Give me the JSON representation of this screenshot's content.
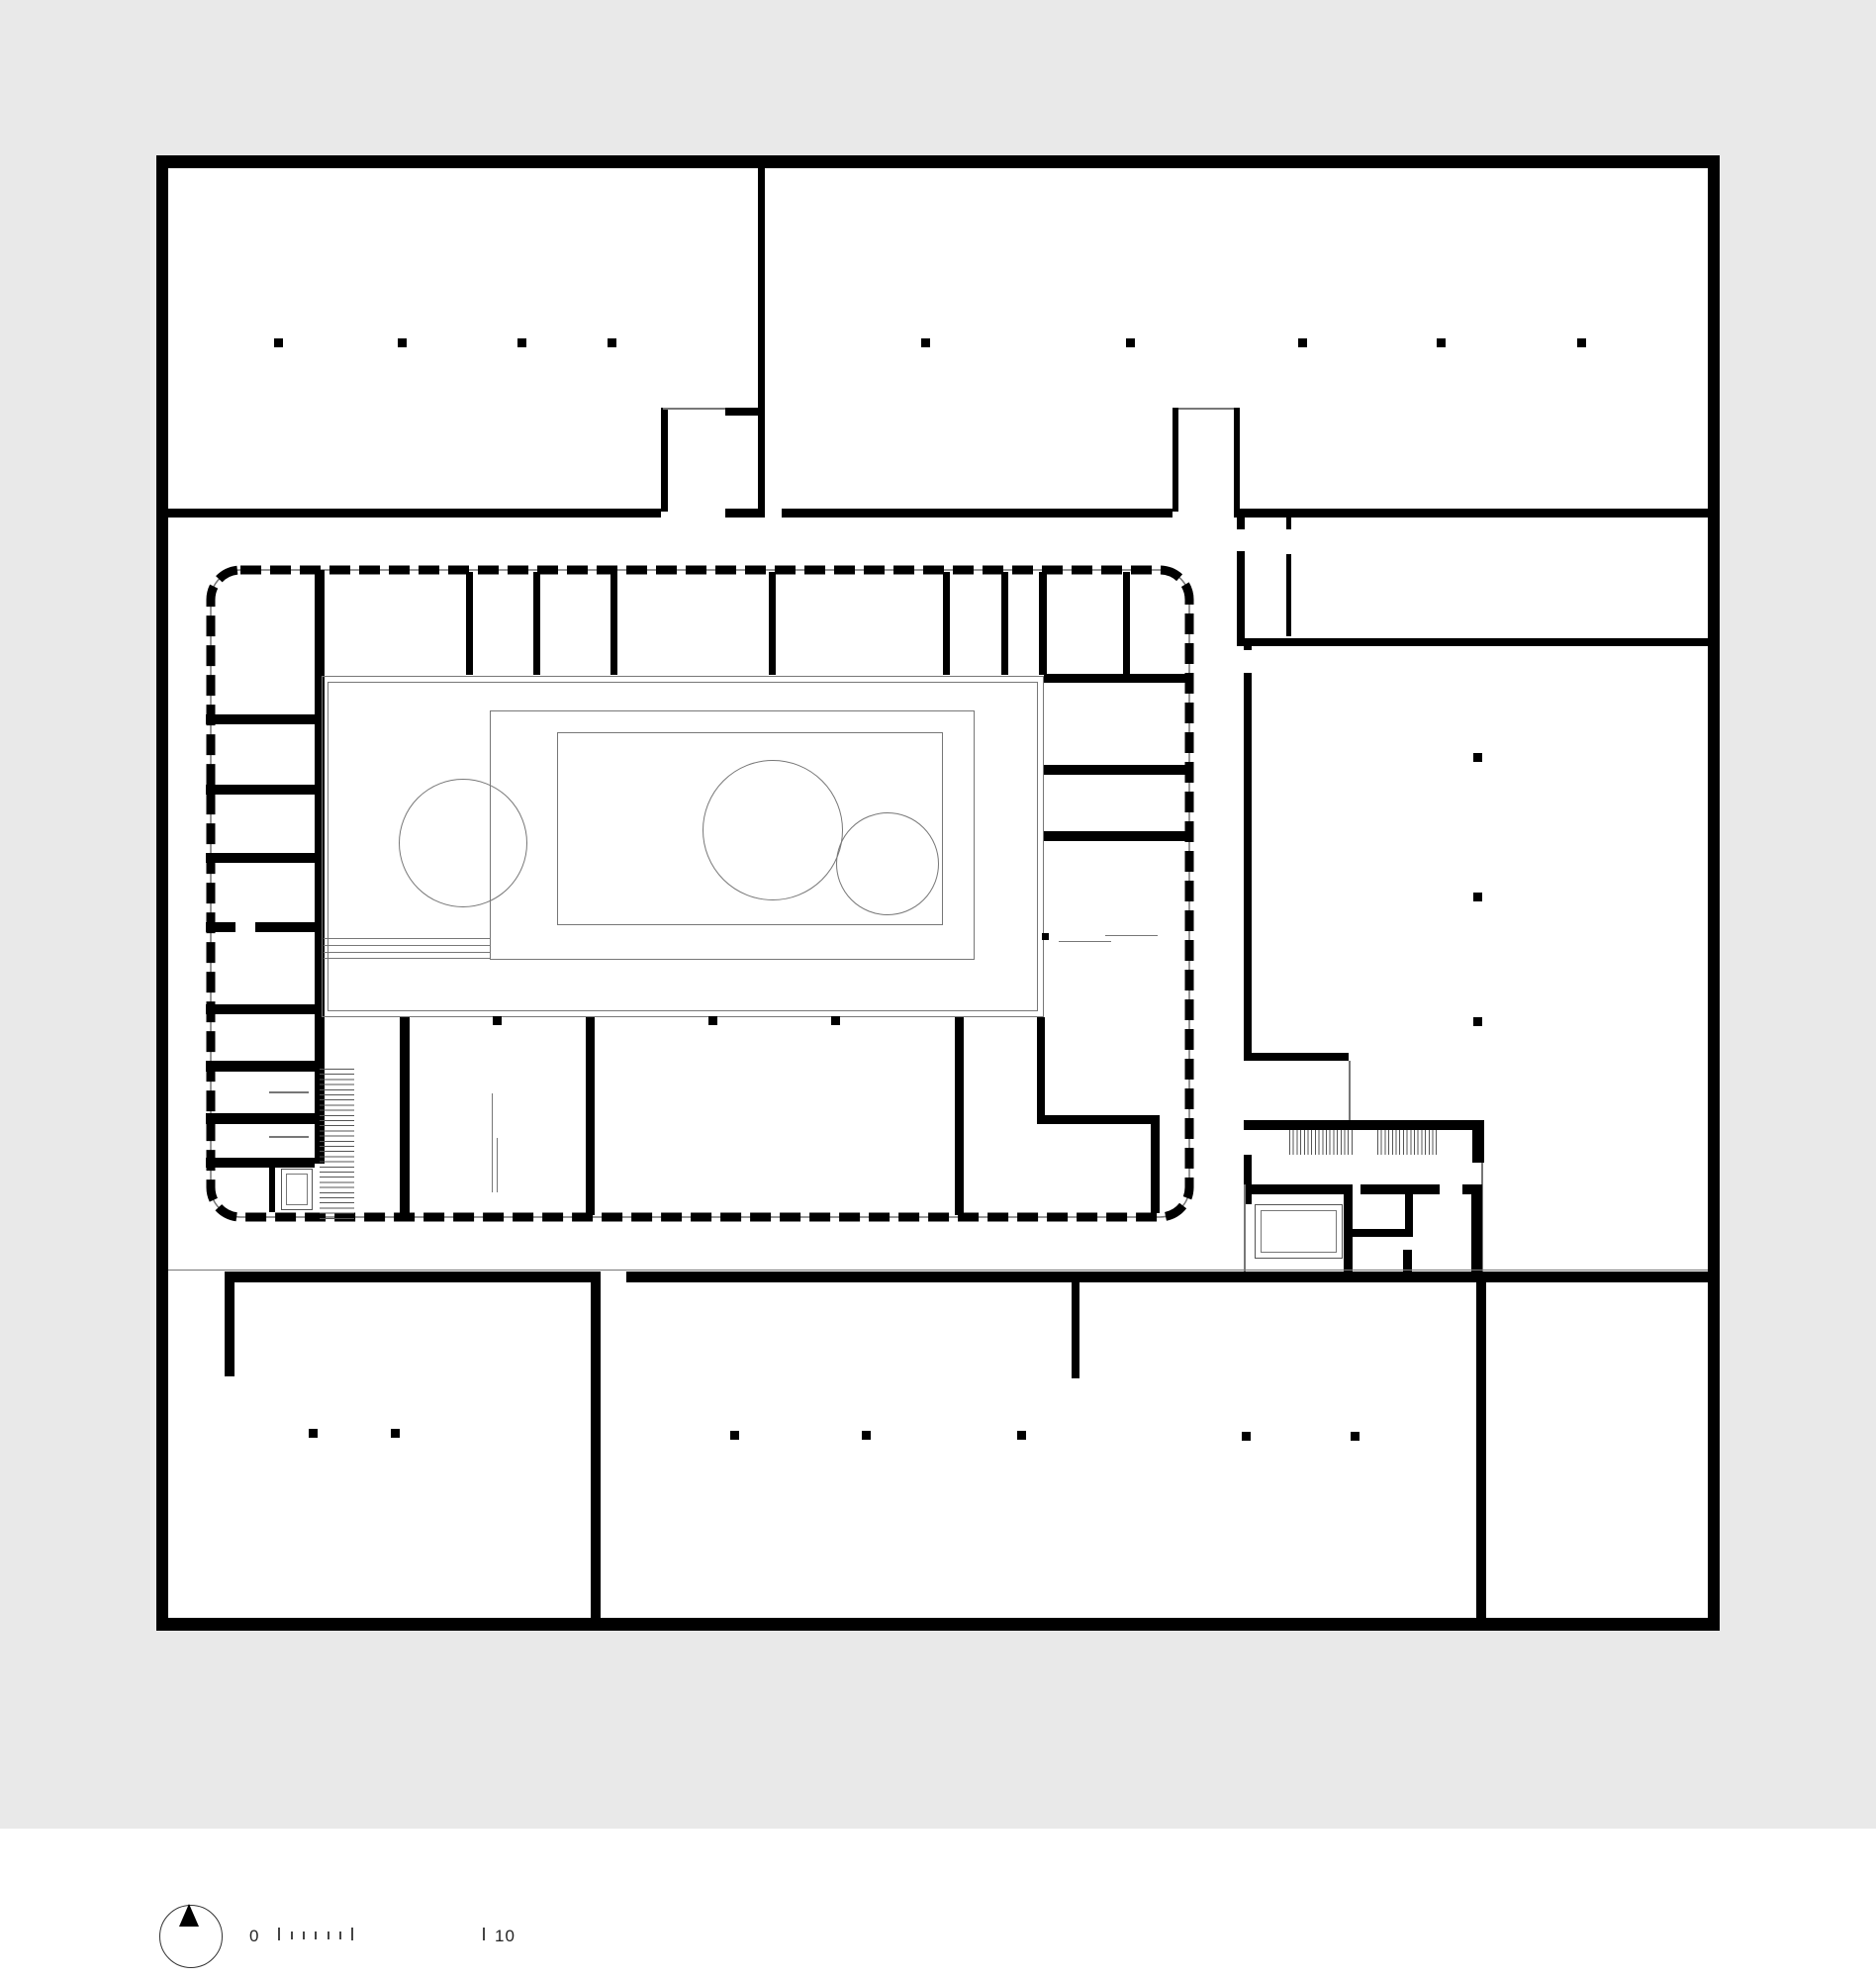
{
  "drawing": {
    "kind": "architectural floor plan",
    "visible_text_present": "scale bar labels only"
  },
  "scale_bar": {
    "zero_label": "0",
    "ten_label": "10"
  },
  "north_indicator": {
    "icon": "north-arrow-icon"
  },
  "colors": {
    "page_background": "#e9e9e9",
    "paper": "#ffffff",
    "wall": "#000000",
    "thin_line": "#777777",
    "text": "#222222"
  }
}
